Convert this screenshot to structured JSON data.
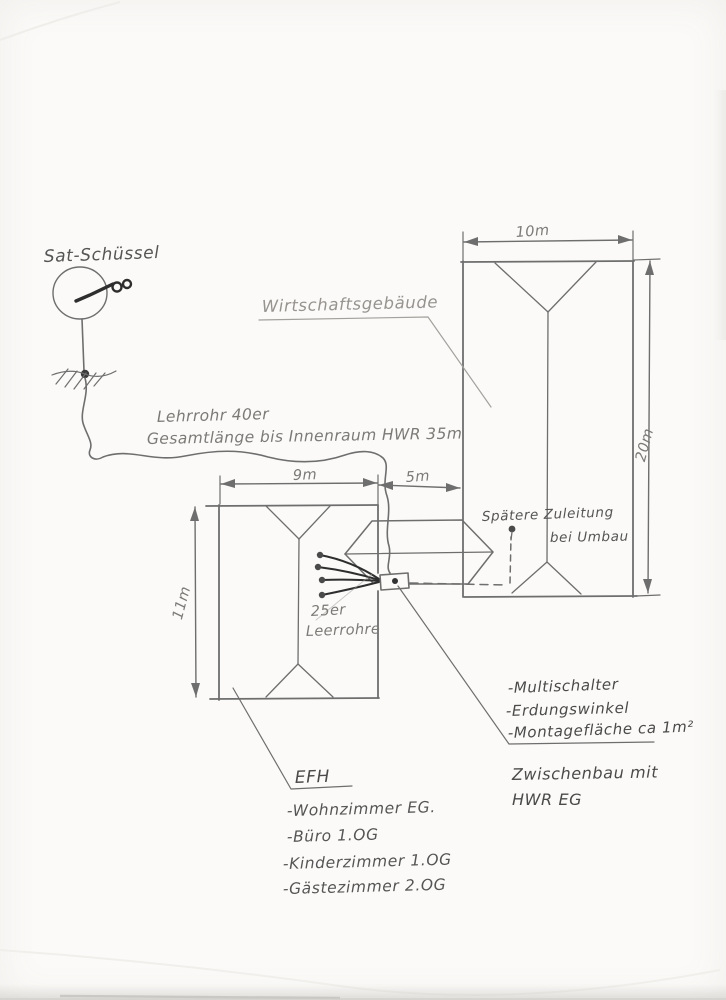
{
  "colors": {
    "paper": "#fbfaf8",
    "pencil": "#6e6e6e",
    "pencil_light": "#a3a19d",
    "pencil_dark": "#4a4a4a",
    "ink": "#2e2e2e"
  },
  "sat_dish": {
    "label": "Sat-Schüssel"
  },
  "cable_note": {
    "line1": "Lehrrohr 40er",
    "line2": "Gesamtlänge bis Innenraum HWR 35m"
  },
  "wirtschaftsgebaeude": {
    "label": "Wirtschaftsgebäude",
    "width": "10m",
    "length": "20m"
  },
  "efh": {
    "label": "EFH",
    "width": "9m",
    "length": "11m",
    "rooms": [
      "-Wohnzimmer EG.",
      "-Büro 1.OG",
      "-Kinderzimmer 1.OG",
      "-Gästezimmer 2.OG"
    ]
  },
  "zwischenbau": {
    "gap": "5m",
    "line1": "Zwischenbau mit",
    "line2": "HWR EG"
  },
  "future_supply": {
    "line1": "Spätere Zuleitung",
    "line2": "bei Umbau"
  },
  "conduits": {
    "line1": "25er",
    "line2": "Leerrohre"
  },
  "equipment": [
    "-Multischalter",
    "-Erdungswinkel",
    "-Montagefläche ca 1m²"
  ]
}
